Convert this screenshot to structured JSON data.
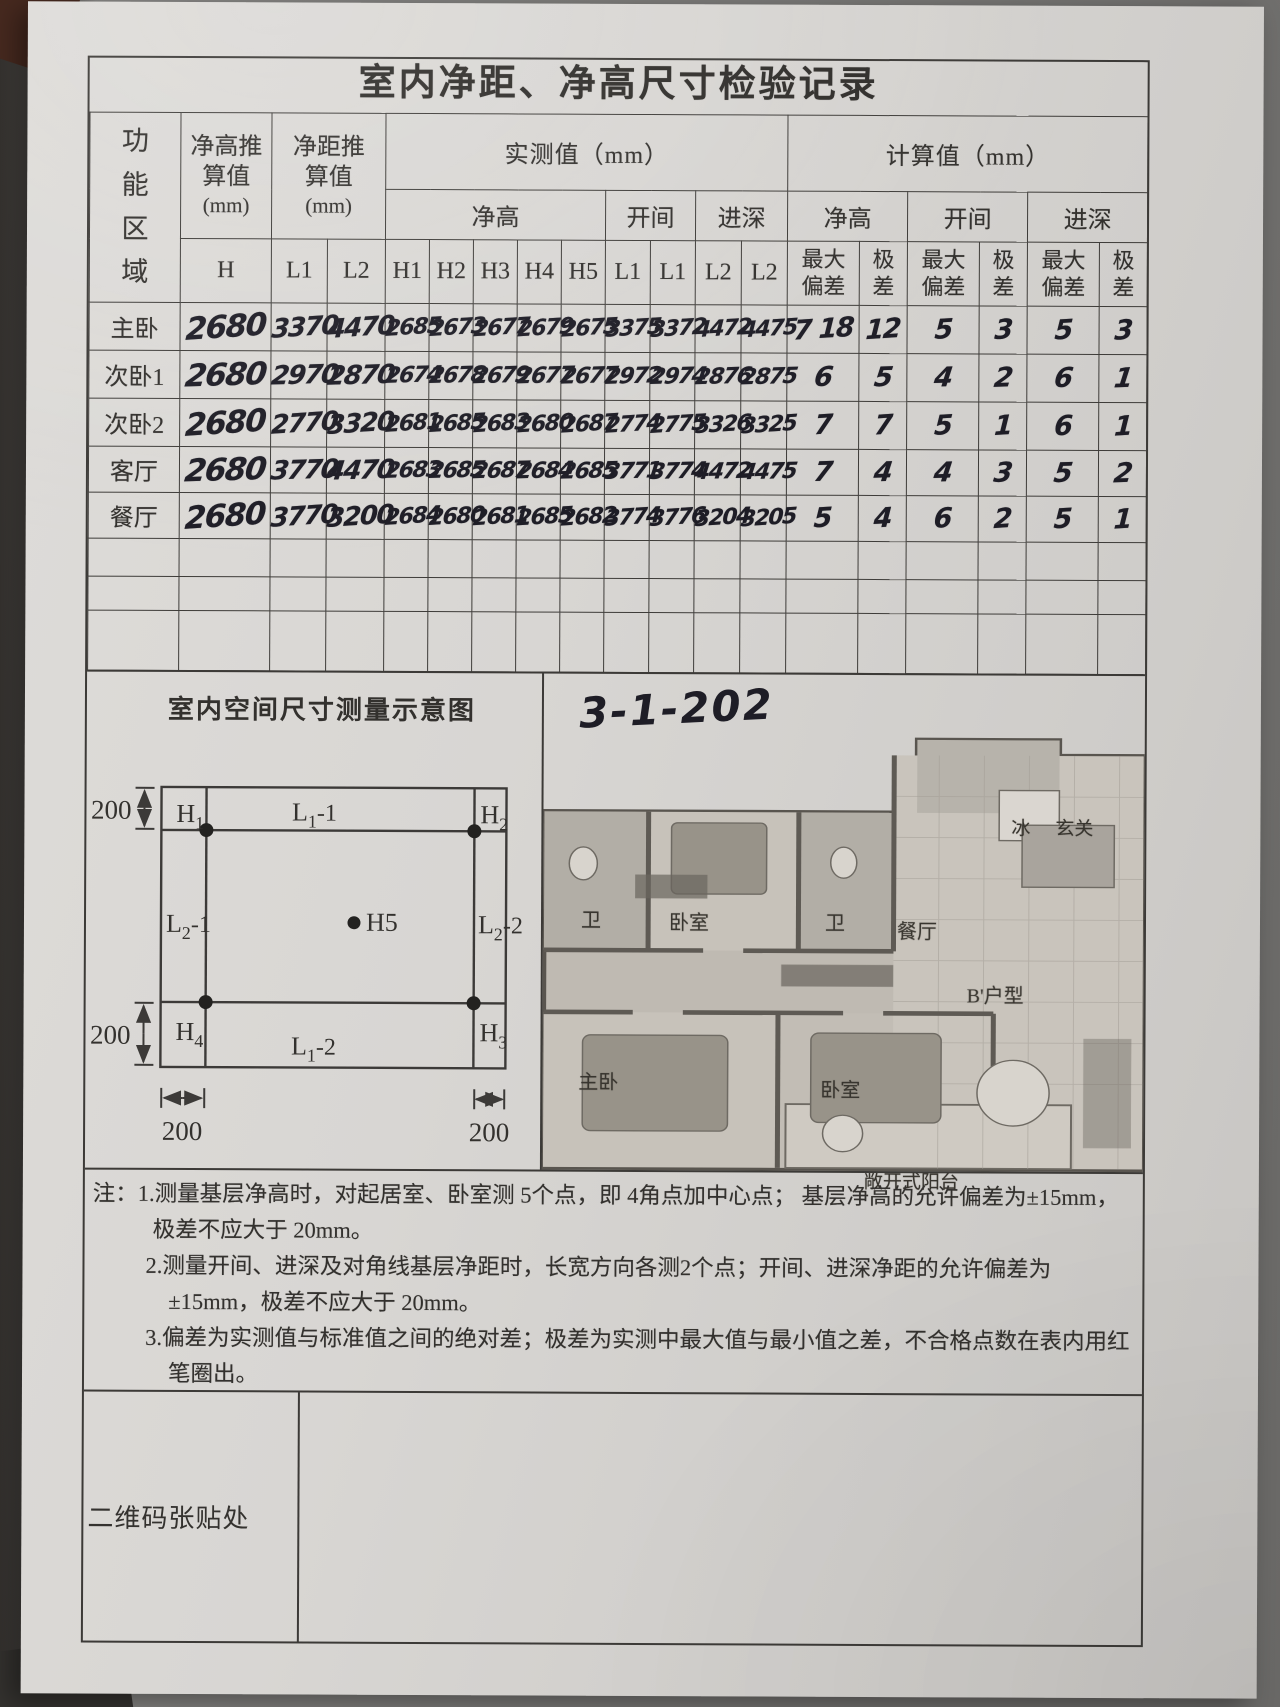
{
  "title": "室内净距、净高尺寸检验记录",
  "table": {
    "headers": {
      "area": "功能区域",
      "h_calc": "净高推算值",
      "d_calc": "净距推算值",
      "unit_small": "(mm)",
      "measured": "实测值（mm）",
      "calculated": "计算值（mm）",
      "clear_height": "净高",
      "bay": "开间",
      "depth": "进深",
      "h": "H",
      "l1": "L1",
      "l2": "L2",
      "h_cols": [
        "H1",
        "H2",
        "H3",
        "H4",
        "H5"
      ],
      "l_cols": [
        "L1",
        "L1",
        "L2",
        "L2"
      ],
      "max_dev": "最大偏差",
      "range": "极差"
    },
    "rows": [
      {
        "area": "主卧",
        "h": 48,
        "v": [
          "2680",
          "3370",
          "4470",
          "2685",
          "2673",
          "2677",
          "2679",
          "2675",
          "3375",
          "3372",
          "4472",
          "4475",
          "7 18",
          "12",
          "5",
          "3",
          "5",
          "3"
        ]
      },
      {
        "area": "次卧1",
        "h": 48,
        "v": [
          "2680",
          "2970",
          "2870",
          "2674",
          "2678",
          "2679",
          "2677",
          "2677",
          "2972",
          "2974",
          "2876",
          "2875",
          "6",
          "5",
          "4",
          "2",
          "6",
          "1"
        ]
      },
      {
        "area": "次卧2",
        "h": 48,
        "v": [
          "2680",
          "2770",
          "3320",
          "2681",
          "2685",
          "2683",
          "2680",
          "2687",
          "2774",
          "2775",
          "3326",
          "3325",
          "7",
          "7",
          "5",
          "1",
          "6",
          "1"
        ]
      },
      {
        "area": "客厅",
        "h": 46,
        "v": [
          "2680",
          "3770",
          "4470",
          "2683",
          "2685",
          "2687",
          "2684",
          "2685",
          "3771",
          "3774",
          "4472",
          "4475",
          "7",
          "4",
          "4",
          "3",
          "5",
          "2"
        ]
      },
      {
        "area": "餐厅",
        "h": 46,
        "v": [
          "2680",
          "3770",
          "3200",
          "2684",
          "2680",
          "2681",
          "2685",
          "2682",
          "3774",
          "3776",
          "3204",
          "3205",
          "5",
          "4",
          "6",
          "2",
          "5",
          "1"
        ]
      },
      {
        "area": "",
        "h": 38,
        "v": [
          "",
          "",
          "",
          "",
          "",
          "",
          "",
          "",
          "",
          "",
          "",
          "",
          "",
          "",
          "",
          "",
          "",
          ""
        ]
      },
      {
        "area": "",
        "h": 34,
        "v": [
          "",
          "",
          "",
          "",
          "",
          "",
          "",
          "",
          "",
          "",
          "",
          "",
          "",
          "",
          "",
          "",
          "",
          ""
        ]
      },
      {
        "area": "",
        "h": 60,
        "v": [
          "",
          "",
          "",
          "",
          "",
          "",
          "",
          "",
          "",
          "",
          "",
          "",
          "",
          "",
          "",
          "",
          "",
          ""
        ]
      }
    ]
  },
  "diagram": {
    "title": "室内空间尺寸测量示意图",
    "dim": "200",
    "points": {
      "h1": {
        "b": "H",
        "s": "1"
      },
      "h2": {
        "b": "H",
        "s": "2"
      },
      "h3": {
        "b": "H",
        "s": "3"
      },
      "h4": {
        "b": "H",
        "s": "4"
      },
      "h5": {
        "b": "H",
        "t": "5"
      },
      "l11": {
        "b": "L",
        "s": "1",
        "t": "-1"
      },
      "l12": {
        "b": "L",
        "s": "1",
        "t": "-2"
      },
      "l21": {
        "b": "L",
        "s": "2",
        "t": "-1"
      },
      "l22": {
        "b": "L",
        "s": "2",
        "t": "-2"
      }
    }
  },
  "floorplan": {
    "unit_no": "3-1-202",
    "labels": [
      {
        "t": "冰",
        "x": 468,
        "y": 76,
        "size": 19
      },
      {
        "t": "玄关",
        "x": 512,
        "y": 76,
        "size": 19
      },
      {
        "t": "卫",
        "x": 38,
        "y": 168,
        "size": 20
      },
      {
        "t": "卧室",
        "x": 126,
        "y": 170,
        "size": 20
      },
      {
        "t": "卫",
        "x": 282,
        "y": 170,
        "size": 20
      },
      {
        "t": "餐厅",
        "x": 354,
        "y": 178,
        "size": 20
      },
      {
        "t": "B'户型",
        "x": 424,
        "y": 242,
        "size": 20
      },
      {
        "t": "主卧",
        "x": 36,
        "y": 330,
        "size": 20
      },
      {
        "t": "卧室",
        "x": 278,
        "y": 337,
        "size": 20
      },
      {
        "t": "敞开式阳台",
        "x": 322,
        "y": 430,
        "size": 19
      }
    ]
  },
  "notes": {
    "prefix": "注：",
    "items": [
      "1.测量基层净高时，对起居室、卧室测 5个点，即 4角点加中心点； 基层净高的允许偏差为±15mm，极差不应大于 20mm。",
      "2.测量开间、进深及对角线基层净距时，长宽方向各测2个点；开间、进深净距的允许偏差为±15mm，极差不应大于 20mm。",
      "3.偏差为实测值与标准值之间的绝对差；极差为实测中最大值与最小值之差，不合格点数在表内用红笔圈出。"
    ]
  },
  "footer": {
    "qr_label": "二维码张贴处"
  }
}
